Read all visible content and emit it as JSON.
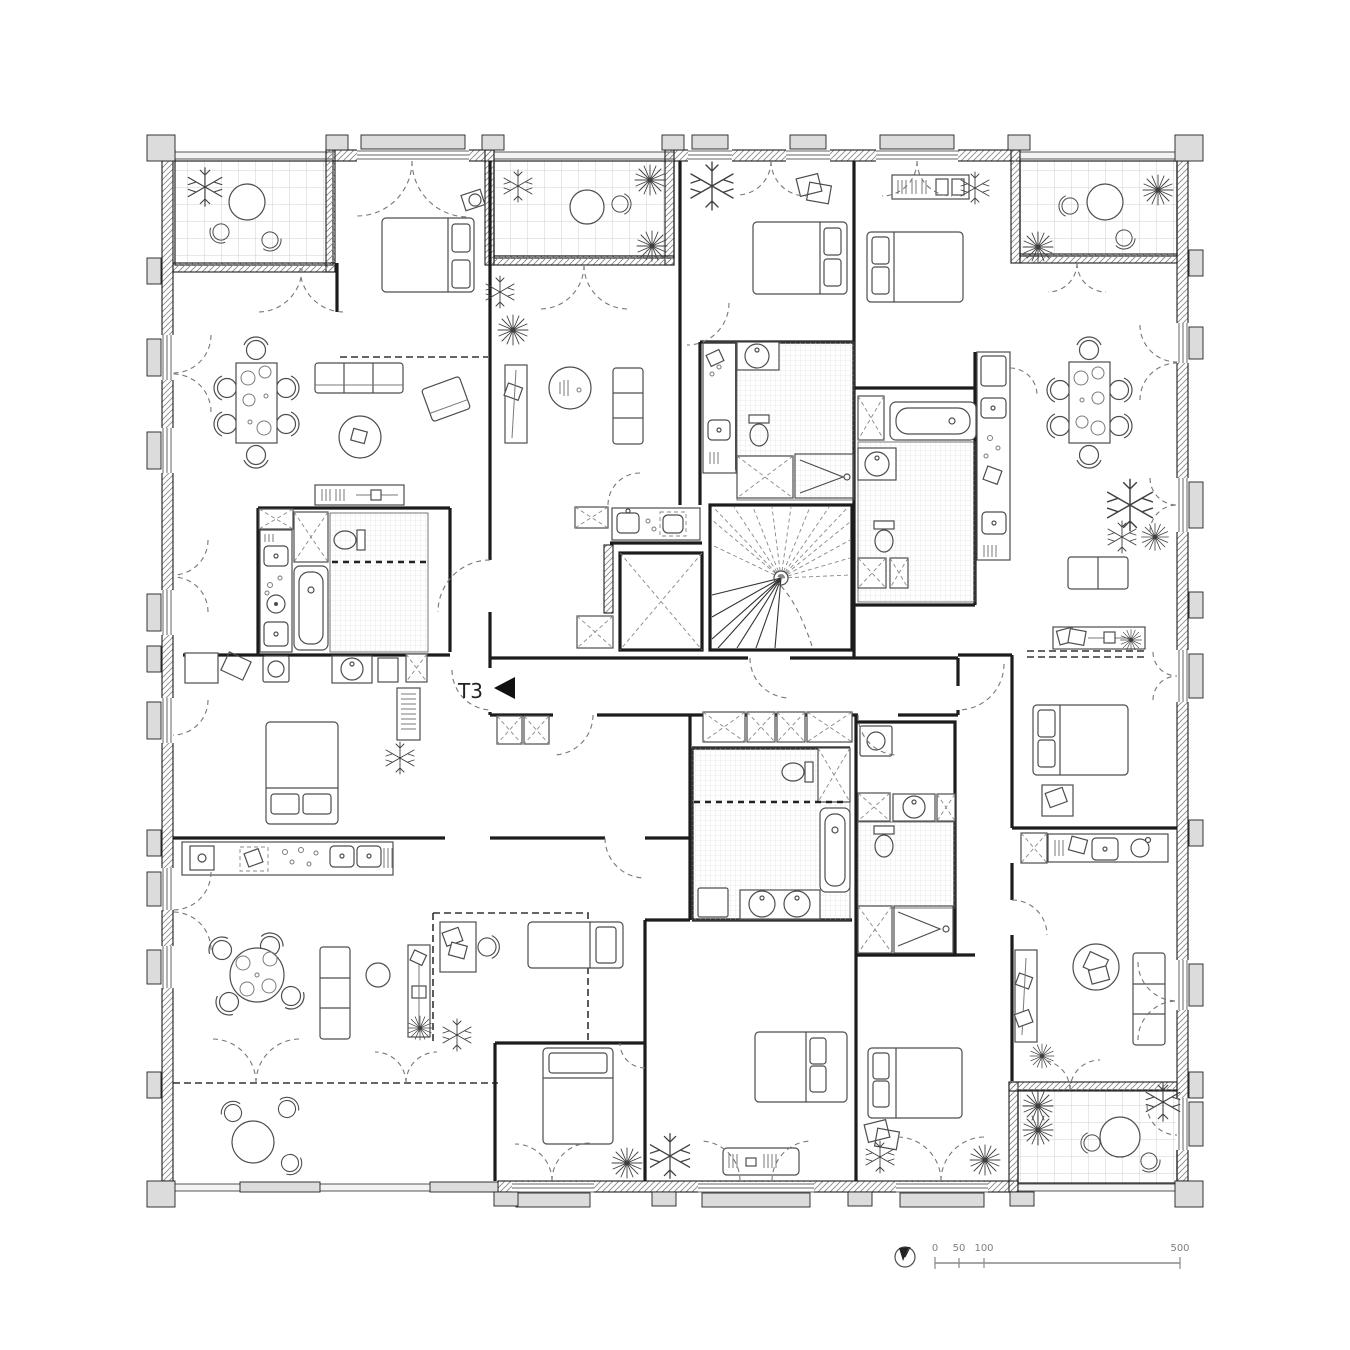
{
  "plan": {
    "unit_label": "T3",
    "unit_arrow": "left-pointing-triangle",
    "scale_bar": {
      "tick_labels": [
        "0",
        "50",
        "100",
        "500"
      ],
      "north_icon": "compass-needle-circle"
    },
    "drawing": {
      "type": "residential-floor-plan",
      "core": [
        "winder-staircase",
        "elevator-shaft",
        "central-corridor",
        "storage-closets"
      ],
      "balconies": [
        "top-left",
        "top-center",
        "top-right",
        "bottom-right",
        "bottom-left-terrace"
      ],
      "apartments": [
        {
          "position": "top-left",
          "rooms": [
            "balcony",
            "bedroom",
            "living-dining",
            "kitchen",
            "bathroom",
            "second-bedroom"
          ]
        },
        {
          "position": "top-center-left",
          "rooms": [
            "balcony",
            "living",
            "kitchen",
            "entry"
          ]
        },
        {
          "position": "top-center",
          "rooms": [
            "bedroom",
            "kitchen",
            "bathroom"
          ]
        },
        {
          "position": "right",
          "rooms": [
            "bedroom",
            "bathroom",
            "kitchen",
            "living-dining",
            "balcony"
          ]
        },
        {
          "position": "center-right",
          "rooms": [
            "bedroom",
            "desk-area",
            "kitchen"
          ]
        },
        {
          "position": "bottom-left",
          "rooms": [
            "kitchen",
            "living-dining",
            "kids-room",
            "bedroom",
            "terrace"
          ]
        },
        {
          "position": "bottom-center",
          "rooms": [
            "bathroom",
            "bedroom",
            "second-bedroom"
          ]
        },
        {
          "position": "bottom-right",
          "rooms": [
            "kitchen",
            "living",
            "bedroom",
            "bathroom",
            "balcony"
          ]
        }
      ],
      "furniture_symbols": [
        "double-bed",
        "single-bed",
        "sofa",
        "armchair",
        "dining-table-with-chairs",
        "round-table",
        "desk",
        "wardrobe",
        "kitchen-counter",
        "sink",
        "cooktop",
        "bathtub",
        "shower",
        "toilet",
        "washbasin",
        "washing-machine",
        "radiator",
        "rug",
        "potted-plant"
      ]
    }
  }
}
